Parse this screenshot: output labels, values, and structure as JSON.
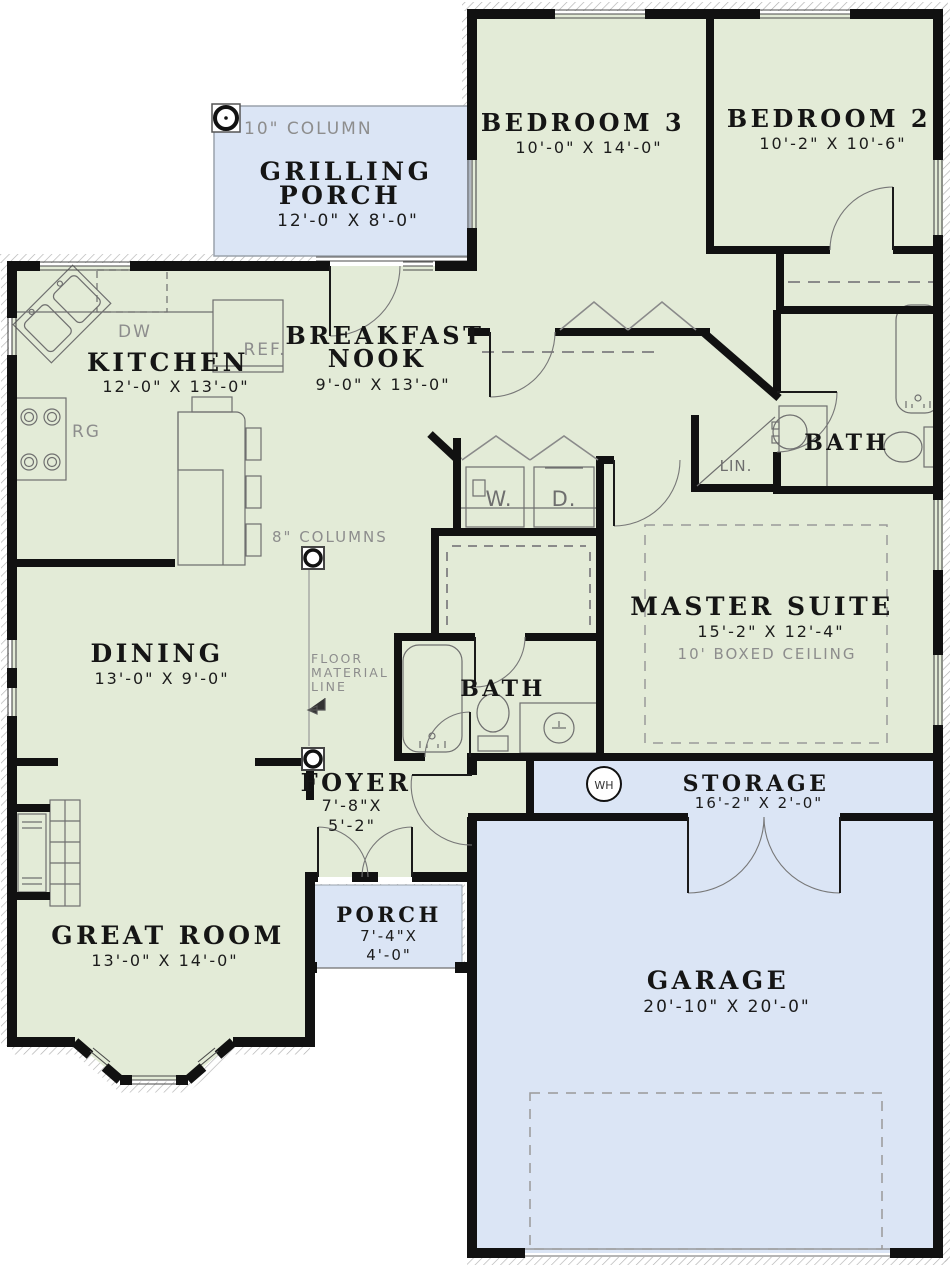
{
  "colors": {
    "room_green": "#e3ebd7",
    "porch_blue": "#dbe5f5",
    "wall_black": "#111111",
    "annotation_gray": "#8d8d8d",
    "hatch_gray": "#b0b0b0"
  },
  "rooms": {
    "grilling_porch": {
      "name1": "GRILLING",
      "name2": "PORCH",
      "dims": "12'-0\" X 8'-0\""
    },
    "bedroom3": {
      "name": "BEDROOM 3",
      "dims": "10'-0\" X 14'-0\""
    },
    "bedroom2": {
      "name": "BEDROOM 2",
      "dims": "10'-2\" X 10'-6\""
    },
    "kitchen": {
      "name": "KITCHEN",
      "dims": "12'-0\" X 13'-0\""
    },
    "breakfast_nook": {
      "name1": "BREAKFAST",
      "name2": "NOOK",
      "dims": "9'-0\" X 13'-0\""
    },
    "bath_hall": {
      "name": "BATH"
    },
    "master_suite": {
      "name": "MASTER SUITE",
      "dims": "15'-2\" X 12'-4\"",
      "note": "10' BOXED CEILING"
    },
    "dining": {
      "name": "DINING",
      "dims": "13'-0\" X 9'-0\""
    },
    "bath_master": {
      "name": "BATH"
    },
    "foyer": {
      "name": "FOYER",
      "dims1": "7'-8\"X",
      "dims2": "5'-2\""
    },
    "storage": {
      "name": "STORAGE",
      "dims": "16'-2\" X 2'-0\""
    },
    "porch": {
      "name": "PORCH",
      "dims1": "7'-4\"X",
      "dims2": "4'-0\""
    },
    "great_room": {
      "name": "GREAT ROOM",
      "dims": "13'-0\" X 14'-0\""
    },
    "garage": {
      "name": "GARAGE",
      "dims": "20'-10\" X 20'-0\""
    }
  },
  "annotations": {
    "column10": "10\" COLUMN",
    "columns8": "8\" COLUMNS",
    "floor_material_1": "FLOOR",
    "floor_material_2": "MATERIAL",
    "floor_material_3": "LINE",
    "linen": "LIN.",
    "washer": "W.",
    "dryer": "D.",
    "water_heater": "WH",
    "dishwasher": "DW",
    "refrigerator": "REF.",
    "range": "RG"
  }
}
